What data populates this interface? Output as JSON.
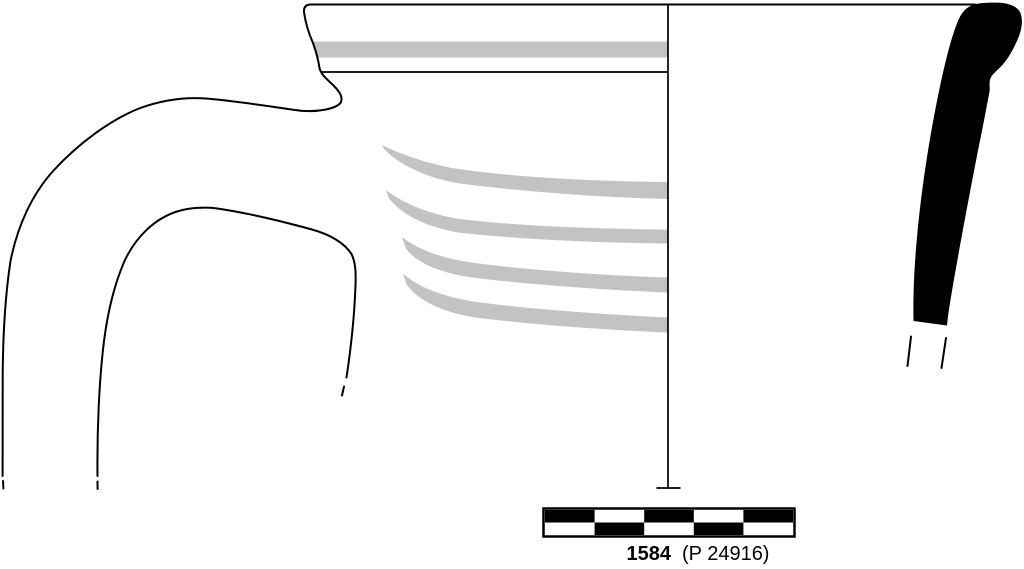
{
  "figure": {
    "description": "Archaeological pottery profile drawing: rim and handle fragment elevation with gray painted bands, vertical axis line, solid black cross-section profile, checkered scale bar and catalog caption",
    "caption": {
      "catalog_number": "1584",
      "inventory_number": "(P 24916)"
    }
  },
  "colors": {
    "background": "#ffffff",
    "line": "#000000",
    "band_gray": "#c3c3c3",
    "section_fill": "#000000",
    "scale_bar_white": "#ffffff"
  },
  "scale_bar": {
    "columns": 5,
    "rows": 2,
    "pattern": [
      [
        1,
        0,
        1,
        0,
        1
      ],
      [
        0,
        1,
        0,
        1,
        0
      ]
    ],
    "x": 543,
    "y": 508,
    "width": 252,
    "height": 29
  }
}
